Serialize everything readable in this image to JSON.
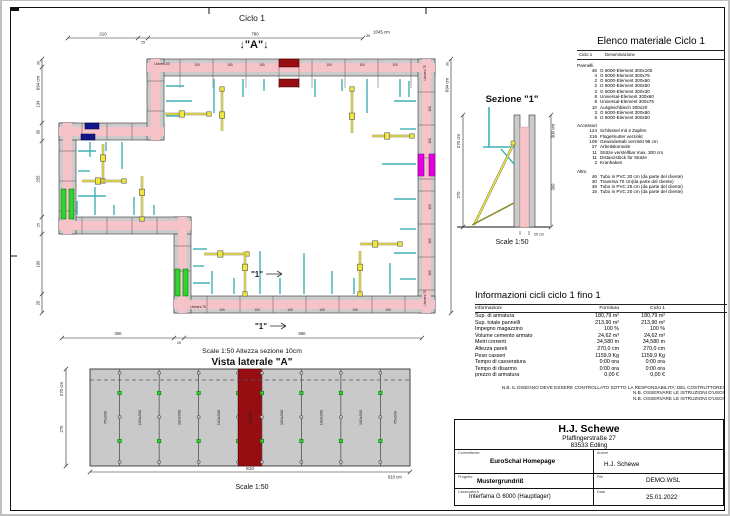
{
  "colors": {
    "wall_pink": "#f6c3c8",
    "panel_gray": "#cbcbcb",
    "highlight_red": "#970e12",
    "highlight_navy": "#15158c",
    "highlight_magenta": "#e200e2",
    "highlight_green": "#2fd42f",
    "brace_yellow": "#f0e83a",
    "tick_cyan": "#3fb0b4",
    "support_olive": "#8a8a2a",
    "vista_gray": "#c9c9c9"
  },
  "plan": {
    "title": "Ciclo 1",
    "marker_a": "↓\"A\"↓",
    "section_mark": "\"1\"",
    "caption": "Scale 1:50   Altezza sezione 10cm",
    "element_label": "100",
    "corner_label_75": "Univers.75",
    "corner_label_60": "Univers.60",
    "dims": {
      "top": [
        "210",
        "25",
        "780",
        "30",
        "1045 cm"
      ],
      "left": [
        "30",
        "694 cm",
        "134",
        "30",
        "255",
        "25",
        "195",
        "20"
      ],
      "right": [
        "30",
        "694 cm"
      ],
      "bottom": [
        "300",
        "25",
        "660"
      ]
    }
  },
  "sezione": {
    "title": "Sezione \"1\"",
    "caption": "Scale 1:50",
    "dim_left_total": "270 cm",
    "dim_left": "270",
    "dim_right_total": "300 cm",
    "dim_right": "300",
    "thickness": "25 cm"
  },
  "vista": {
    "title": "Vista laterale \"A\"",
    "caption": "Scale 1:50",
    "dim_left_total": "270 cm",
    "dim_left": "270",
    "dim_bottom": "810",
    "dim_bottom_total": "810 cm",
    "panels": [
      {
        "label": "75x300",
        "w": 75,
        "red": false
      },
      {
        "label": "100x300",
        "w": 100,
        "red": false
      },
      {
        "label": "100x300",
        "w": 100,
        "red": false
      },
      {
        "label": "100x300",
        "w": 100,
        "red": false
      },
      {
        "label": "60x300",
        "w": 60,
        "red": true
      },
      {
        "label": "100x300",
        "w": 100,
        "red": false
      },
      {
        "label": "100x300",
        "w": 100,
        "red": false
      },
      {
        "label": "100x300",
        "w": 100,
        "red": false
      },
      {
        "label": "75x300",
        "w": 75,
        "red": false
      }
    ]
  },
  "elenco": {
    "title": "Elenco materiale  Ciclo 1",
    "col_qty": "Ciclo 1",
    "col_name": "Denominazione",
    "sections": [
      {
        "name": "Pannelli",
        "items": [
          [
            "46",
            "G 6000-Element 300x100"
          ],
          [
            "4",
            "G 6000-Element 300x75"
          ],
          [
            "2",
            "G 6000-Element 300x60"
          ],
          [
            "2",
            "G 6000-Element 300x50"
          ],
          [
            "2",
            "G 6000-Element 300x30"
          ],
          [
            "8",
            "Universal-Element 300x60"
          ],
          [
            "8",
            "Universal-Element 300x75"
          ],
          [
            "10",
            "Ausgleichblech 300x20"
          ],
          [
            "3",
            "G 6000-Element 300x60"
          ],
          [
            "5",
            "G 6000-Element 300x50"
          ]
        ]
      },
      {
        "name": "Accessori",
        "items": [
          [
            "124",
            "Schlüssel mit 2 Zapfen"
          ],
          [
            "216",
            "Flügelmutter verzinkt"
          ],
          [
            "108",
            "Gewindestab verzinkt 95 cm"
          ],
          [
            "27",
            "Arbeitskonsole"
          ],
          [
            "11",
            "Stütze verstellbar max. 300 cm"
          ],
          [
            "11",
            "Distanzstück für Stütze"
          ],
          [
            "2",
            "Kranhaken"
          ]
        ]
      },
      {
        "name": "Altro",
        "items": [
          [
            "46",
            "Tubo in PVC 30 cm (da parte del cliente)"
          ],
          [
            "30",
            "Traversa 70 cm(da parte del cliente)"
          ],
          [
            "48",
            "Tubo in PVC 25 cm (da parte del cliente)"
          ],
          [
            "15",
            "Tubo in PVC 20 cm (da parte del cliente)"
          ]
        ]
      }
    ]
  },
  "info": {
    "title": "Informazioni cicli  ciclo 1 fino 1",
    "headers": [
      "Informazioni",
      "Fornitura",
      "Ciclo 1"
    ],
    "rows": [
      [
        "Sup. di armatura",
        "180,79 m²",
        "180,79 m²"
      ],
      [
        "Sup. totale pannelli",
        "213,90 m²",
        "213,90 m²"
      ],
      [
        "Impegno magazzino",
        "100 %",
        "100 %"
      ],
      [
        "Volume cemento armato",
        "24,62 m³",
        "24,62 m³"
      ],
      [
        "Metri correnti",
        "34,580 m",
        "34,580 m"
      ],
      [
        "Altezza pareti",
        "270,0 cm",
        "270,0 cm"
      ],
      [
        "Peso casseri",
        "1159,9 Kg",
        "1159,9 Kg"
      ],
      [
        "Tempo di casseratura",
        "0:00 ora",
        "0:00 ora"
      ],
      [
        "Tempo di disarmo",
        "0:00 ora",
        "0:00 ora"
      ],
      [
        "prezzo di armatura",
        "0,00 €",
        "0,00 €"
      ]
    ],
    "notes": [
      "N.B. IL DISEGNO DEVE ESSERE CONTROLLATO SOTTO LA RESPONSABILITA' DEL COSTRUTTORE!",
      "N.B. OSSERVARE LE ISTRUZIONI D'USO!",
      "N.B. OSSERVARE LE ISTRUZIONI D'USO!"
    ]
  },
  "titleblock": {
    "company": "H.J. Schewe",
    "address1": "Pfaffingerstraße 27",
    "address2": "83533 Edling",
    "fields": [
      {
        "label": "Committente",
        "value": "EuroSchal Homepage"
      },
      {
        "label": "Autore",
        "value": "H.J. Schewe"
      },
      {
        "label": "Progetto",
        "value": "Mustergrundriß"
      },
      {
        "label": "File",
        "value": "DEMO.WSL"
      },
      {
        "label": "Casseratura",
        "value": "Interfama G 6000 (Hauptlager)"
      },
      {
        "label": "Data",
        "value": "25.01.2022"
      }
    ]
  }
}
